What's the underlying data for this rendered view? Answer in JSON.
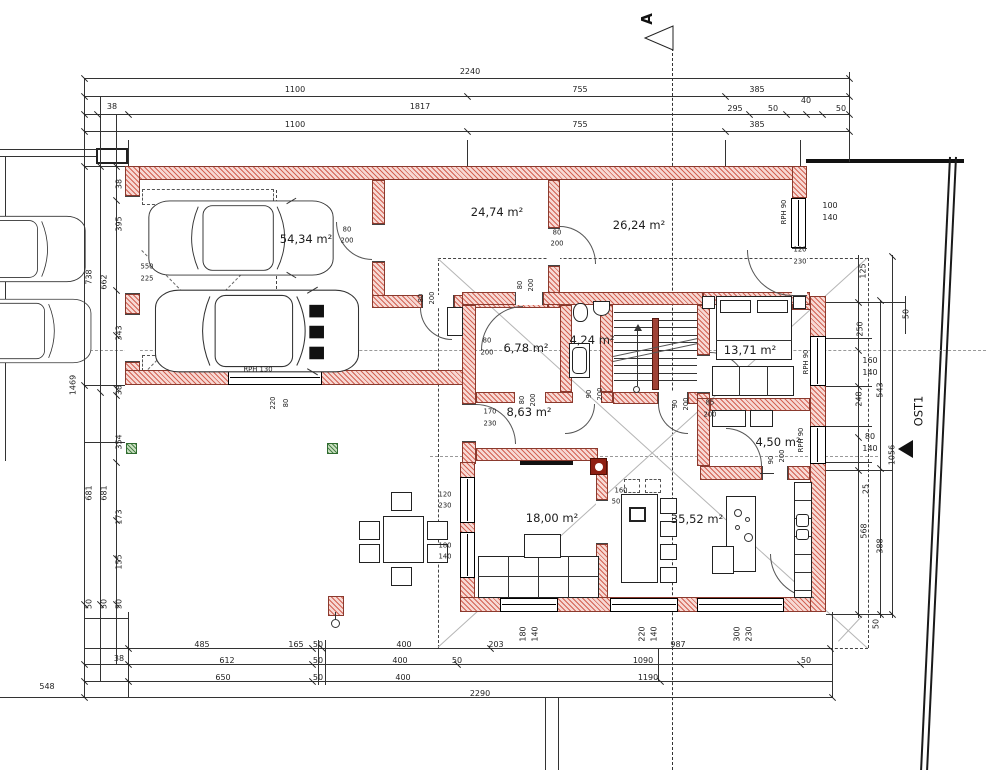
{
  "markers": {
    "section_label": "A",
    "orientation_label": "OST1"
  },
  "rooms": [
    {
      "t": "54,34 m²",
      "x": 306,
      "y": 239
    },
    {
      "t": "24,74 m²",
      "x": 497,
      "y": 212
    },
    {
      "t": "26,24 m²",
      "x": 639,
      "y": 225
    },
    {
      "t": "6,78 m²",
      "x": 526,
      "y": 348
    },
    {
      "t": "4,24 m²",
      "x": 592,
      "y": 340
    },
    {
      "t": "13,71 m²",
      "x": 750,
      "y": 350
    },
    {
      "t": "8,63 m²",
      "x": 529,
      "y": 412
    },
    {
      "t": "4,50 m²",
      "x": 778,
      "y": 442
    },
    {
      "t": "18,00 m²",
      "x": 552,
      "y": 518
    },
    {
      "t": "35,52 m²",
      "x": 697,
      "y": 519
    }
  ],
  "dims": [
    {
      "t": "2240",
      "x": 470,
      "y": 72
    },
    {
      "t": "1100",
      "x": 295,
      "y": 90
    },
    {
      "t": "755",
      "x": 580,
      "y": 90
    },
    {
      "t": "385",
      "x": 757,
      "y": 90
    },
    {
      "t": "38",
      "x": 112,
      "y": 107
    },
    {
      "t": "1817",
      "x": 420,
      "y": 107
    },
    {
      "t": "295",
      "x": 735,
      "y": 109
    },
    {
      "t": "50",
      "x": 773,
      "y": 109
    },
    {
      "t": "40",
      "x": 806,
      "y": 101
    },
    {
      "t": "50",
      "x": 841,
      "y": 109
    },
    {
      "t": "1100",
      "x": 295,
      "y": 125
    },
    {
      "t": "755",
      "x": 580,
      "y": 125
    },
    {
      "t": "385",
      "x": 757,
      "y": 125
    },
    {
      "t": "738",
      "x": 89,
      "y": 277,
      "r": 1
    },
    {
      "t": "1469",
      "x": 73,
      "y": 385,
      "r": 1
    },
    {
      "t": "681",
      "x": 89,
      "y": 493,
      "r": 1
    },
    {
      "t": "662",
      "x": 104,
      "y": 282,
      "r": 1
    },
    {
      "t": "681",
      "x": 104,
      "y": 493,
      "r": 1
    },
    {
      "t": "38",
      "x": 119,
      "y": 184,
      "r": 1
    },
    {
      "t": "395",
      "x": 119,
      "y": 224,
      "r": 1
    },
    {
      "t": "343",
      "x": 119,
      "y": 333,
      "r": 1
    },
    {
      "t": "38",
      "x": 119,
      "y": 390,
      "r": 1
    },
    {
      "t": "354",
      "x": 119,
      "y": 442,
      "r": 1
    },
    {
      "t": "173",
      "x": 119,
      "y": 517,
      "r": 1
    },
    {
      "t": "155",
      "x": 119,
      "y": 562,
      "r": 1
    },
    {
      "t": "50",
      "x": 89,
      "y": 604,
      "r": 1
    },
    {
      "t": "50",
      "x": 104,
      "y": 604,
      "r": 1
    },
    {
      "t": "50",
      "x": 119,
      "y": 604,
      "r": 1
    },
    {
      "t": "548",
      "x": 47,
      "y": 687
    },
    {
      "t": "38",
      "x": 119,
      "y": 659
    },
    {
      "t": "485",
      "x": 202,
      "y": 645
    },
    {
      "t": "165",
      "x": 296,
      "y": 645
    },
    {
      "t": "50",
      "x": 318,
      "y": 645
    },
    {
      "t": "400",
      "x": 404,
      "y": 645
    },
    {
      "t": "203",
      "x": 496,
      "y": 645
    },
    {
      "t": "987",
      "x": 678,
      "y": 645
    },
    {
      "t": "612",
      "x": 227,
      "y": 661
    },
    {
      "t": "50",
      "x": 318,
      "y": 661
    },
    {
      "t": "400",
      "x": 400,
      "y": 661
    },
    {
      "t": "50",
      "x": 457,
      "y": 661
    },
    {
      "t": "1090",
      "x": 643,
      "y": 661
    },
    {
      "t": "50",
      "x": 806,
      "y": 661
    },
    {
      "t": "650",
      "x": 223,
      "y": 678
    },
    {
      "t": "50",
      "x": 318,
      "y": 678
    },
    {
      "t": "400",
      "x": 403,
      "y": 678
    },
    {
      "t": "1190",
      "x": 648,
      "y": 678
    },
    {
      "t": "2290",
      "x": 480,
      "y": 694
    },
    {
      "t": "180",
      "x": 523,
      "y": 634,
      "r": 1
    },
    {
      "t": "140",
      "x": 535,
      "y": 634,
      "r": 1
    },
    {
      "t": "220",
      "x": 642,
      "y": 634,
      "r": 1
    },
    {
      "t": "140",
      "x": 654,
      "y": 634,
      "r": 1
    },
    {
      "t": "300",
      "x": 737,
      "y": 634,
      "r": 1
    },
    {
      "t": "230",
      "x": 749,
      "y": 634,
      "r": 1
    },
    {
      "t": "50",
      "x": 876,
      "y": 624,
      "r": 1
    },
    {
      "t": "100",
      "x": 830,
      "y": 206
    },
    {
      "t": "140",
      "x": 830,
      "y": 218
    },
    {
      "t": "125",
      "x": 863,
      "y": 271,
      "r": 1
    },
    {
      "t": "250",
      "x": 860,
      "y": 329,
      "r": 1
    },
    {
      "t": "50",
      "x": 906,
      "y": 314,
      "r": 1
    },
    {
      "t": "160",
      "x": 870,
      "y": 361
    },
    {
      "t": "140",
      "x": 870,
      "y": 373
    },
    {
      "t": "543",
      "x": 880,
      "y": 390,
      "r": 1
    },
    {
      "t": "248",
      "x": 859,
      "y": 399,
      "r": 1
    },
    {
      "t": "80",
      "x": 870,
      "y": 437
    },
    {
      "t": "140",
      "x": 870,
      "y": 449
    },
    {
      "t": "1056",
      "x": 892,
      "y": 455,
      "r": 1
    },
    {
      "t": "25",
      "x": 866,
      "y": 489,
      "r": 1
    },
    {
      "t": "568",
      "x": 864,
      "y": 531,
      "r": 1
    },
    {
      "t": "388",
      "x": 880,
      "y": 546,
      "r": 1
    }
  ],
  "annos": [
    {
      "t": "80",
      "x": 347,
      "y": 230
    },
    {
      "t": "200",
      "x": 347,
      "y": 241
    },
    {
      "t": "RPH 130",
      "x": 258,
      "y": 370
    },
    {
      "t": "220",
      "x": 273,
      "y": 403,
      "r": 1
    },
    {
      "t": "80",
      "x": 286,
      "y": 403,
      "r": 1
    },
    {
      "t": "550",
      "x": 147,
      "y": 267
    },
    {
      "t": "225",
      "x": 147,
      "y": 279
    },
    {
      "t": "80",
      "x": 421,
      "y": 298,
      "r": 1
    },
    {
      "t": "200",
      "x": 432,
      "y": 298,
      "r": 1
    },
    {
      "t": "80",
      "x": 557,
      "y": 233
    },
    {
      "t": "200",
      "x": 557,
      "y": 244
    },
    {
      "t": "RPH 90",
      "x": 784,
      "y": 212,
      "r": 1
    },
    {
      "t": "120",
      "x": 800,
      "y": 250
    },
    {
      "t": "230",
      "x": 800,
      "y": 262
    },
    {
      "t": "80",
      "x": 520,
      "y": 285,
      "r": 1
    },
    {
      "t": "200",
      "x": 531,
      "y": 285,
      "r": 1
    },
    {
      "t": "80",
      "x": 487,
      "y": 341
    },
    {
      "t": "200",
      "x": 487,
      "y": 353
    },
    {
      "t": "90",
      "x": 589,
      "y": 394,
      "r": 1
    },
    {
      "t": "200",
      "x": 600,
      "y": 394,
      "r": 1
    },
    {
      "t": "80",
      "x": 522,
      "y": 400,
      "r": 1
    },
    {
      "t": "200",
      "x": 533,
      "y": 400,
      "r": 1
    },
    {
      "t": "170",
      "x": 490,
      "y": 412
    },
    {
      "t": "230",
      "x": 490,
      "y": 424
    },
    {
      "t": "85",
      "x": 710,
      "y": 403
    },
    {
      "t": "200",
      "x": 710,
      "y": 415
    },
    {
      "t": "90",
      "x": 675,
      "y": 404,
      "r": 1
    },
    {
      "t": "200",
      "x": 686,
      "y": 404,
      "r": 1
    },
    {
      "t": "RPH 90",
      "x": 806,
      "y": 362,
      "r": 1
    },
    {
      "t": "RPH 90",
      "x": 801,
      "y": 440,
      "r": 1
    },
    {
      "t": "90",
      "x": 771,
      "y": 460,
      "r": 1
    },
    {
      "t": "200",
      "x": 782,
      "y": 456,
      "r": 1
    },
    {
      "t": "120",
      "x": 445,
      "y": 495
    },
    {
      "t": "230",
      "x": 445,
      "y": 506
    },
    {
      "t": "180",
      "x": 445,
      "y": 546
    },
    {
      "t": "140",
      "x": 445,
      "y": 557
    },
    {
      "t": "160",
      "x": 621,
      "y": 491
    },
    {
      "t": "50",
      "x": 616,
      "y": 502
    }
  ]
}
